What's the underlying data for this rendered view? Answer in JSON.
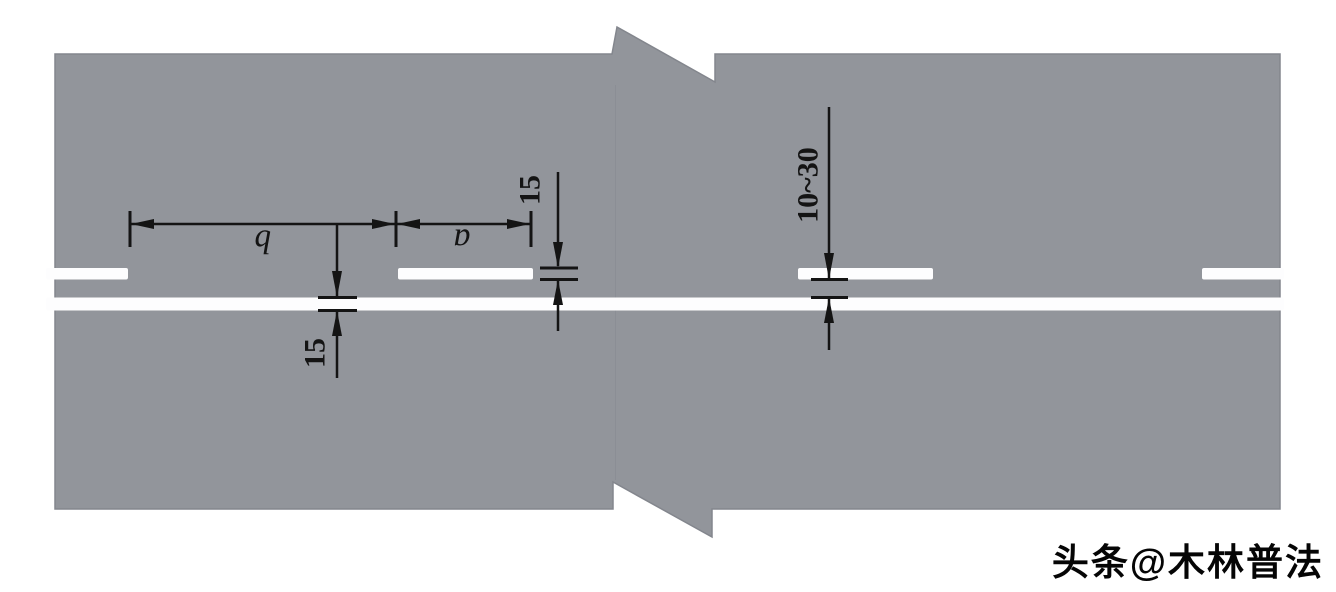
{
  "diagram": {
    "dimension_labels": {
      "gap": "b",
      "segment": "a",
      "dashed_line_width": "15",
      "solid_line_width": "15",
      "line_spacing_range": "10~30"
    },
    "colors": {
      "road_gray": "#92959b",
      "road_edge": "#83868d",
      "marking_white": "#fdfdfe",
      "dimension_black": "#141414",
      "background": "#ffffff"
    }
  },
  "watermark": {
    "text": "头条@木林普法"
  }
}
